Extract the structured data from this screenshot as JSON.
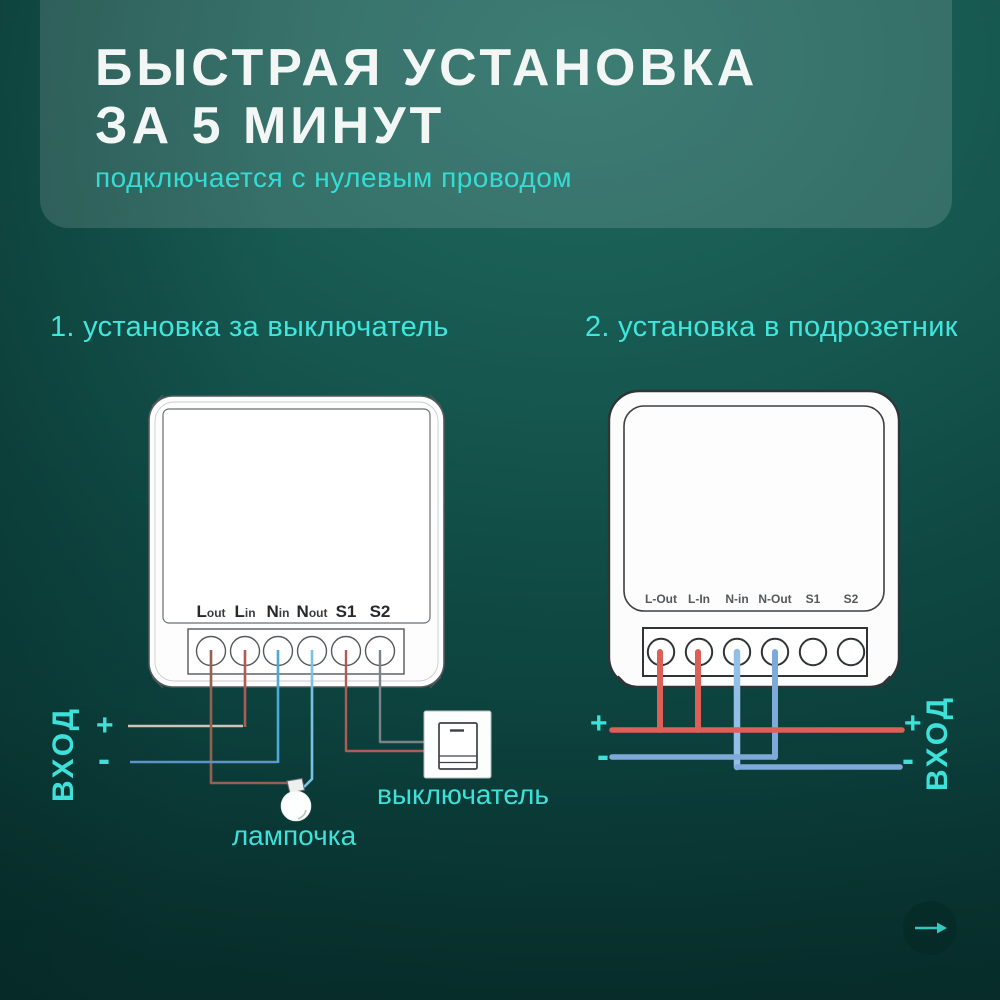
{
  "header": {
    "title_line1": "БЫСТРАЯ УСТАНОВКА",
    "title_line2": "ЗА 5 МИНУТ",
    "subtitle": "подключается с нулевым проводом"
  },
  "sections": {
    "left_title": "1. установка за выключатель",
    "right_title": "2. установка в подрозетник"
  },
  "device1": {
    "terminals": [
      {
        "big": "L",
        "small": "out"
      },
      {
        "big": "L",
        "small": "in"
      },
      {
        "big": "N",
        "small": "in"
      },
      {
        "big": "N",
        "small": "out"
      },
      {
        "big": "S1",
        "small": ""
      },
      {
        "big": "S2",
        "small": ""
      }
    ],
    "input_label": "ВХОД",
    "plus": "+",
    "minus": "-",
    "lamp_label": "лампочка",
    "switch_label": "выключатель"
  },
  "device2": {
    "terminals": [
      "L-Out",
      "L-In",
      "N-in",
      "N-Out",
      "S1",
      "S2"
    ],
    "input_label": "ВХОД",
    "plus_left": "+",
    "minus_left": "-",
    "plus_right": "+",
    "minus_right": "-"
  },
  "colors": {
    "background_top": "#20695f",
    "background_bottom": "#093533",
    "accent_cyan": "#3ce2d9",
    "title_white": "#f2f7f6",
    "device_outline": "#54595c",
    "device_outline_dark": "#303437",
    "device_body": "#fdfdfd"
  },
  "wires": {
    "diagram1": [
      {
        "name": "plus-feed-wire",
        "color": "#cfc4b8",
        "width": 2.6,
        "points": [
          [
            128,
            726
          ],
          [
            243,
            726
          ]
        ]
      },
      {
        "name": "l-in-wire",
        "color": "#b05a55",
        "width": 2.6,
        "points": [
          [
            245,
            727
          ],
          [
            245,
            650
          ]
        ]
      },
      {
        "name": "l-out-wire",
        "color": "#96604f",
        "width": 2.6,
        "points": [
          [
            211,
            650
          ],
          [
            211,
            783
          ],
          [
            289,
            783
          ],
          [
            293,
            787
          ]
        ]
      },
      {
        "name": "minus-feed-wire",
        "color": "#5e93c7",
        "width": 2.6,
        "points": [
          [
            130,
            762
          ],
          [
            277,
            762
          ]
        ]
      },
      {
        "name": "n-in-wire",
        "color": "#4fa9d6",
        "width": 2.6,
        "points": [
          [
            278,
            763
          ],
          [
            278,
            650
          ]
        ]
      },
      {
        "name": "n-out-wire",
        "color": "#79c2e4",
        "width": 2.6,
        "points": [
          [
            312,
            650
          ],
          [
            312,
            779
          ],
          [
            304,
            787
          ]
        ]
      },
      {
        "name": "s2-wire",
        "color": "#79838a",
        "width": 2.4,
        "points": [
          [
            380,
            650
          ],
          [
            380,
            742
          ],
          [
            425,
            742
          ]
        ]
      },
      {
        "name": "s1-wire",
        "color": "#b35a55",
        "width": 2.4,
        "points": [
          [
            346,
            650
          ],
          [
            346,
            751
          ],
          [
            425,
            751
          ]
        ]
      }
    ],
    "diagram2": [
      {
        "name": "n-in-wire",
        "color": "#93bfe6",
        "width": 6.5,
        "points": [
          [
            737,
            652
          ],
          [
            737,
            767
          ]
        ]
      },
      {
        "name": "n-out-wire",
        "color": "#7fa9d9",
        "width": 6,
        "points": [
          [
            775,
            652
          ],
          [
            775,
            757
          ]
        ]
      },
      {
        "name": "l-out-wire",
        "color": "#dd5f58",
        "width": 6,
        "points": [
          [
            660,
            652
          ],
          [
            660,
            730
          ]
        ]
      },
      {
        "name": "l-in-wire",
        "color": "#dd5f58",
        "width": 6,
        "points": [
          [
            698,
            652
          ],
          [
            698,
            730
          ]
        ]
      },
      {
        "name": "plus-bus-wire",
        "color": "#dd5f58",
        "width": 5.5,
        "points": [
          [
            612,
            730
          ],
          [
            902,
            730
          ]
        ]
      },
      {
        "name": "minus-left-wire",
        "color": "#7fa9d9",
        "width": 5.5,
        "points": [
          [
            612,
            757
          ],
          [
            775,
            757
          ]
        ]
      },
      {
        "name": "minus-right-wire",
        "color": "#7fa9d9",
        "width": 5.5,
        "points": [
          [
            737,
            767
          ],
          [
            900,
            767
          ]
        ]
      }
    ]
  }
}
